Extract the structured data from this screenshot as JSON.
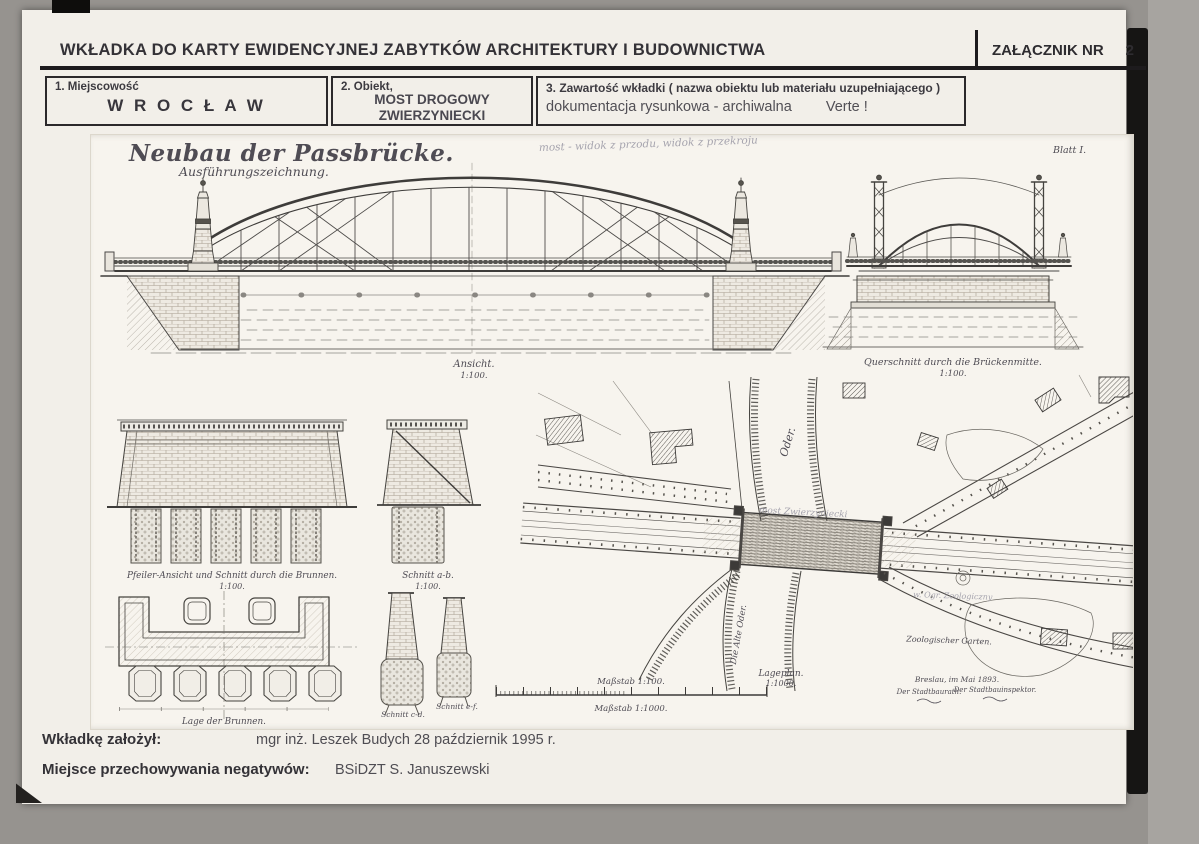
{
  "header": {
    "title": "WKŁADKA DO KARTY EWIDENCYJNEJ ZABYTKÓW ARCHITEKTURY I BUDOWNICTWA",
    "attachment": {
      "label": "ZAŁĄCZNIK NR",
      "number": "2"
    }
  },
  "fields": {
    "place": {
      "label": "1. Miejscowość",
      "value": "W R O C Ł A W"
    },
    "object": {
      "label": "2. Obiekt,",
      "line1": "MOST DROGOWY",
      "line2": "ZWIERZYNIECKI"
    },
    "contents": {
      "label": "3. Zawartość wkładki ( nazwa obiektu lub materiału uzupełniającego )",
      "value": "dokumentacja rysunkowa - archiwalna",
      "note": "Verte !"
    }
  },
  "drawing": {
    "title": "Neubau der Passbrücke.",
    "subtitle": "Ausführungszeichnung.",
    "sheet_no": "Blatt I.",
    "pencil_note": "most - widok z przodu, widok z przekroju",
    "elevation": {
      "caption": "Ansicht.",
      "scale": "1:100."
    },
    "cross_section": {
      "caption": "Querschnitt durch die Brückenmitte.",
      "scale": "1:100."
    },
    "pier": {
      "caption": "Pfeiler-Ansicht und Schnitt durch die Brunnen.",
      "scale": "1:100."
    },
    "section_ab": {
      "caption": "Schnitt a-b.",
      "scale": "1:100."
    },
    "wells_plan": {
      "caption": "Lage der Brunnen."
    },
    "section_cd": {
      "caption": "Schnitt c-d."
    },
    "section_ef": {
      "caption": "Schnitt e-f."
    },
    "scale_bars": {
      "top": "Maßstab 1:100.",
      "bottom": "Maßstab 1:1000."
    },
    "site_plan": {
      "caption": "Lageplan.",
      "scale": "1:1000.",
      "river_upper": "Oder.",
      "river_lower": "Die Alte Oder.",
      "bridge_pencil": "most Zwierzyniecki",
      "garden": "Zoologischer Garten.",
      "garden_pencil": "w. Ogr. Zoologiczny",
      "signature": {
        "place_date": "Breslau, im Mai 1893.",
        "left": "Der Stadtbaurath.",
        "right": "Der Stadtbauinspektor."
      }
    }
  },
  "footer": {
    "created": {
      "label": "Wkładkę założył:",
      "value": "mgr inż. Leszek Budych  28 październik 1995 r."
    },
    "negatives": {
      "label": "Miejsce przechowywania negatywów:",
      "value": "BSiDZT  S. Januszewski"
    }
  }
}
